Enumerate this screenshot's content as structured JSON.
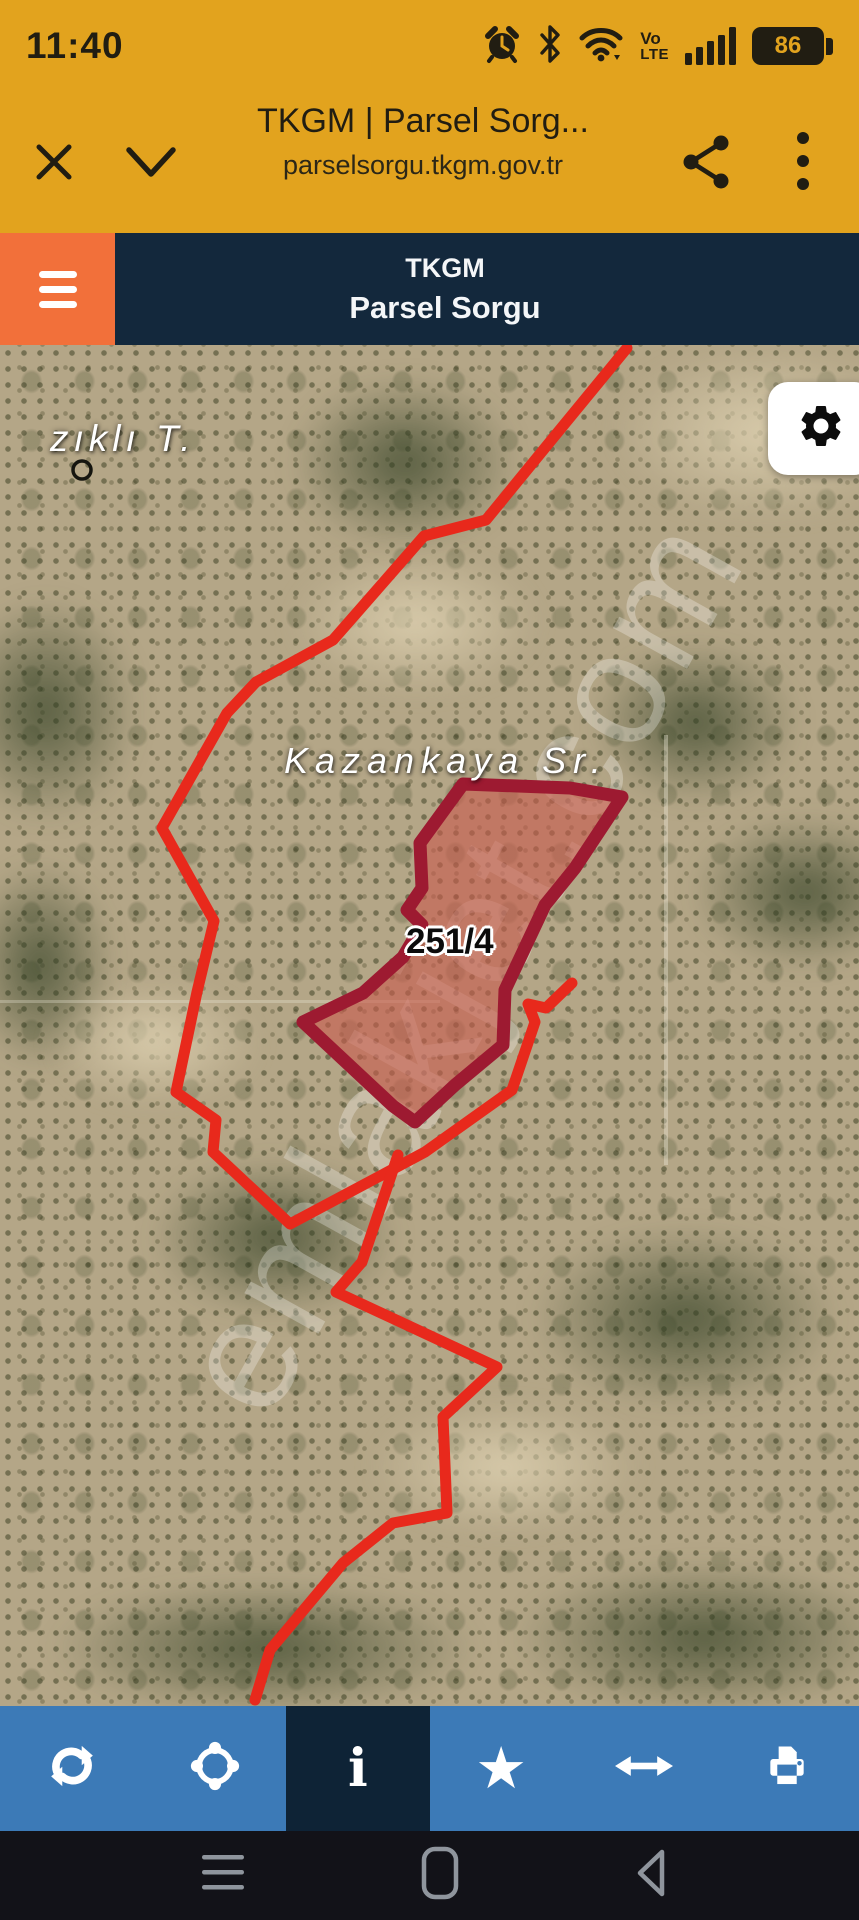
{
  "status_bar": {
    "time": "11:40",
    "battery_percent": "86",
    "volte_top": "Vo",
    "volte_bottom": "LTE",
    "icons": [
      "alarm-icon",
      "bluetooth-icon",
      "wifi-icon",
      "volte-icon",
      "signal-icon",
      "battery-icon"
    ]
  },
  "browser_bar": {
    "title": "TKGM | Parsel Sorg...",
    "url": "parselsorgu.tkgm.gov.tr",
    "icons": [
      "close-icon",
      "chevron-down-icon",
      "share-icon",
      "overflow-menu-icon"
    ]
  },
  "app_header": {
    "title_line1": "TKGM",
    "title_line2": "Parsel Sorgu",
    "menu_icon": "hamburger-menu-icon"
  },
  "map": {
    "type": "satellite-imagery",
    "labels": {
      "place": "zıklı T.",
      "street": "Kazankaya Sr.",
      "parcel_number": "251/4"
    },
    "watermark": "emlakjet.com",
    "settings_icon": "gear-icon",
    "colors": {
      "boundary_red": "#e8291c",
      "parcel_stroke": "#9d1a31",
      "parcel_fill": "rgba(201,90,76,0.6)",
      "marker_black": "#15150f"
    }
  },
  "toolbar": {
    "background": "#3c7ab7",
    "active_background": "#0e2336",
    "items": [
      {
        "name": "refresh",
        "icon": "refresh-icon",
        "active": false
      },
      {
        "name": "locate",
        "icon": "locate-icon",
        "active": false
      },
      {
        "name": "info",
        "icon": "info-icon",
        "glyph": "i",
        "active": true
      },
      {
        "name": "favorite",
        "icon": "star-icon",
        "glyph": "★",
        "active": false
      },
      {
        "name": "measure",
        "icon": "horizontal-arrows-icon",
        "active": false
      },
      {
        "name": "print",
        "icon": "printer-icon",
        "active": false
      }
    ]
  },
  "nav_bar": {
    "items": [
      "menu-icon",
      "home-icon",
      "back-icon"
    ]
  },
  "colors": {
    "amber": "#e2a31e",
    "orange": "#f2703a",
    "navy": "#13283c",
    "toolbar_blue": "#3c7ab7",
    "nav_black": "#121218"
  }
}
